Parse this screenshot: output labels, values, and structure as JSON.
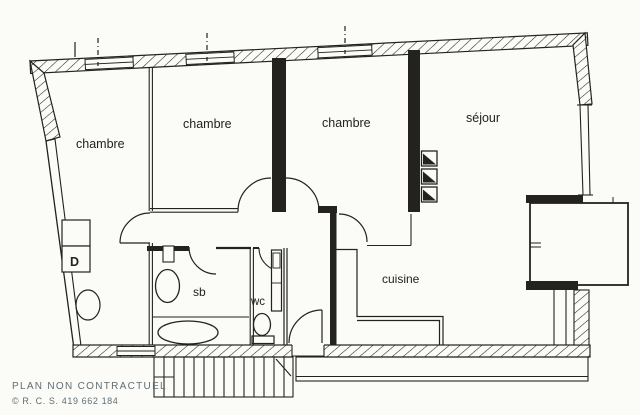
{
  "colors": {
    "paper": "#fbfbf7",
    "ink": "#23221e",
    "footer": "#5f6e75"
  },
  "rooms": {
    "bedroom_left": {
      "label": "chambre"
    },
    "bedroom_middle": {
      "label": "chambre"
    },
    "bedroom_right": {
      "label": "chambre"
    },
    "living_room": {
      "label": "séjour"
    },
    "kitchen": {
      "label": "cuisine"
    },
    "bathroom": {
      "label": "sb"
    },
    "toilet": {
      "label": "wc"
    },
    "closet": {
      "label": "D"
    }
  },
  "footer": {
    "disclaimer": "PLAN NON CONTRACTUEL",
    "registration": "© R. C. S. 419 662 184"
  }
}
